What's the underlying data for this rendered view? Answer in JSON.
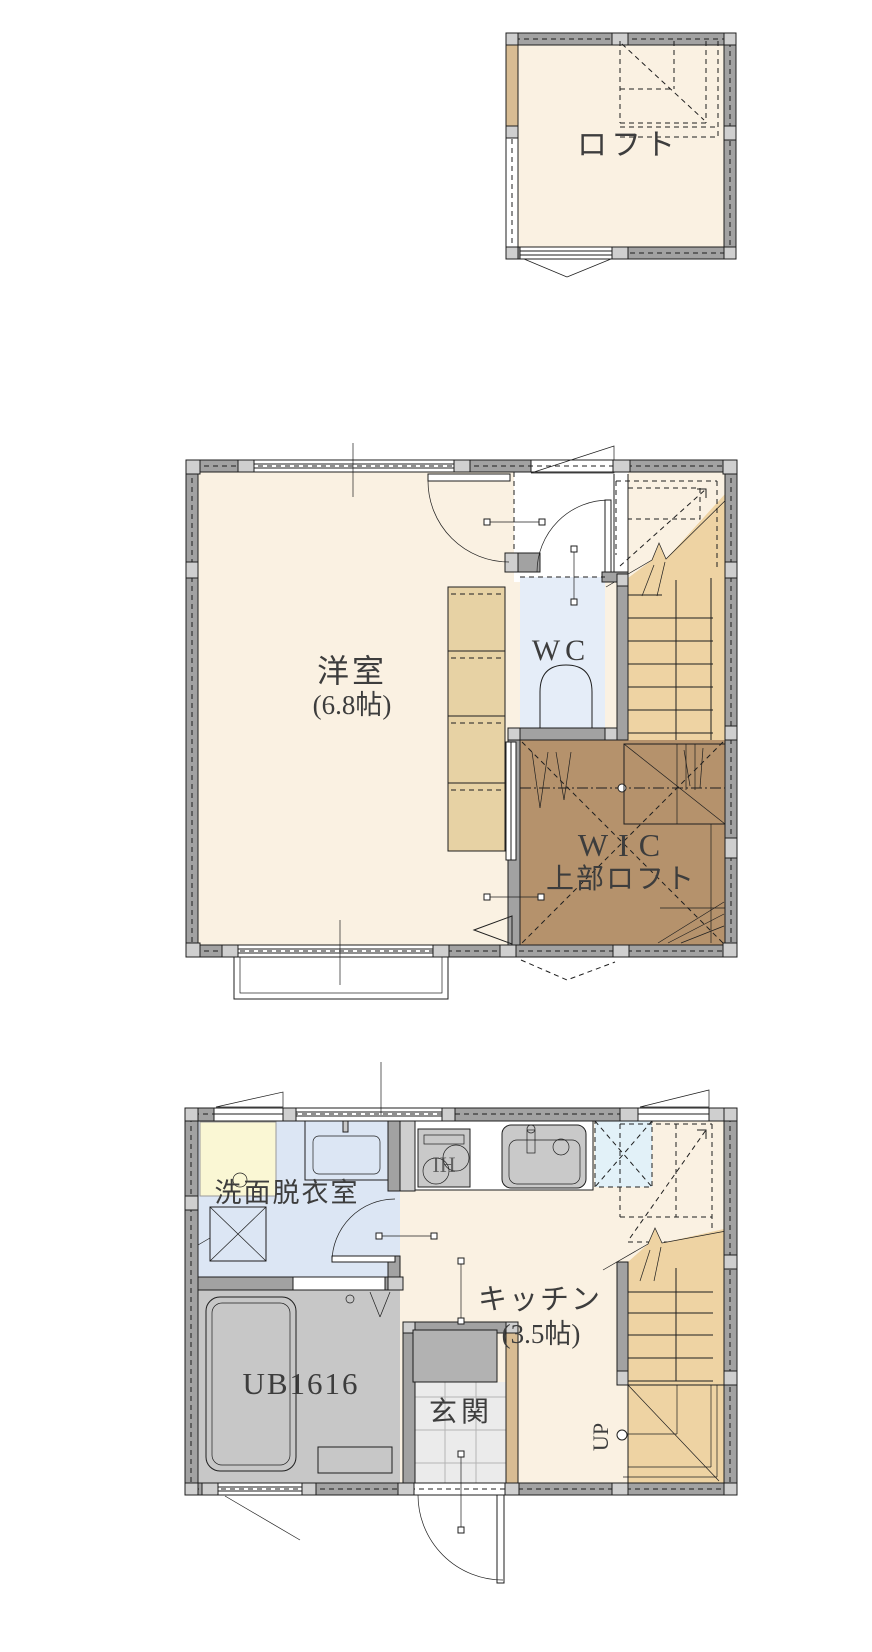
{
  "page": {
    "background": "#ffffff"
  },
  "loft_floor": {
    "label": "ロフト"
  },
  "second_floor": {
    "room": {
      "label": "洋室",
      "size": "(6.8帖)"
    },
    "wc": {
      "label": "WC"
    },
    "wic": {
      "label": "WIC",
      "sublabel": "上部ロフト"
    }
  },
  "first_floor": {
    "washroom": {
      "label": "洗面脱衣室"
    },
    "bath": {
      "label": "UB1616"
    },
    "entrance": {
      "label": "玄関"
    },
    "kitchen": {
      "label": "キッチン",
      "size": "(3.5帖)",
      "stove_label": "IH"
    },
    "stairs": {
      "up_label": "UP"
    }
  },
  "colors": {
    "wall": "#a2a2a2",
    "post": "#cfcfcf",
    "floor_cream": "#faf1e2",
    "stair_tan": "#eed3a3",
    "wic_brown": "#b5926c",
    "closet_tan": "#e7d2a4",
    "wc_blue": "#e5edf8",
    "washroom_blue": "#dce6f4",
    "bath_gray": "#c7c7c7",
    "tile_gray": "#ebebeb",
    "pan_yellow": "#faf7d4",
    "fixture_gray": "#c9c9c9",
    "cabinet_gray": "#b2b2b2",
    "hatch_blue": "#e2f1f8",
    "wood_tan": "#d8bc93",
    "label": "#3d3d3d"
  }
}
